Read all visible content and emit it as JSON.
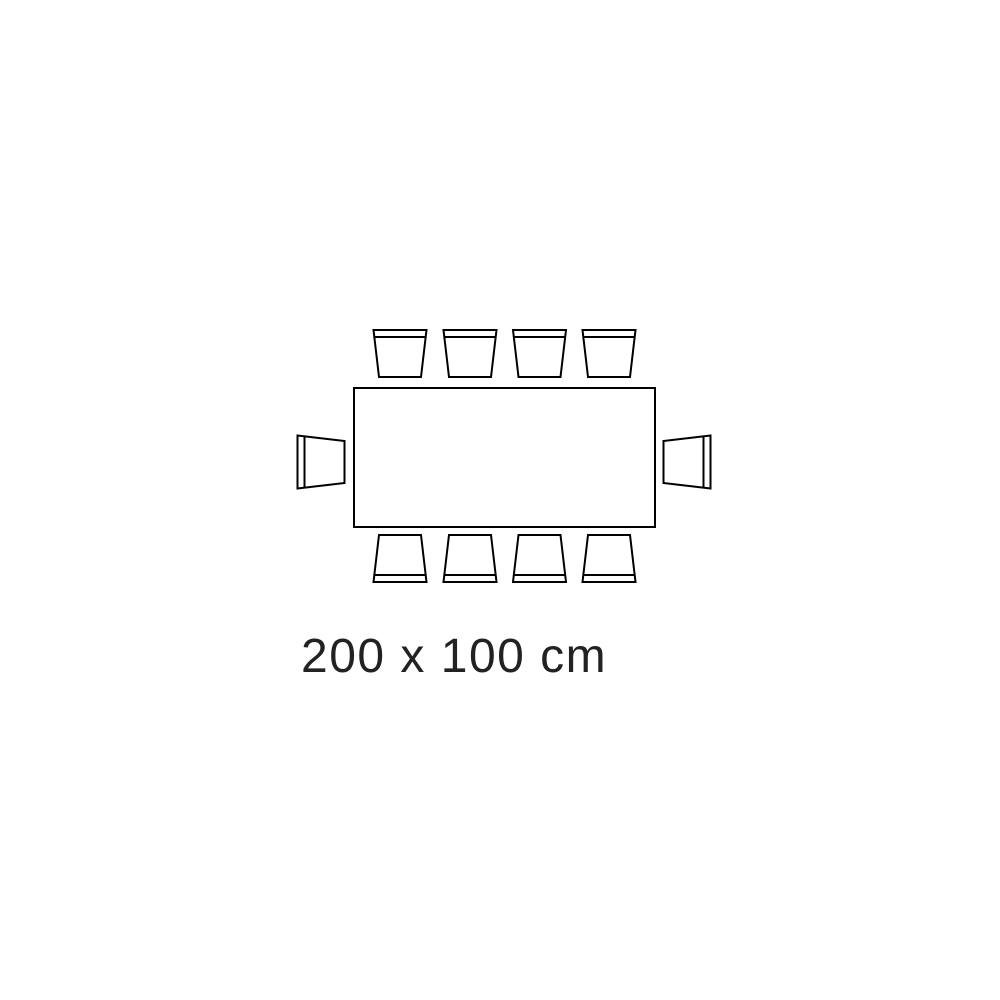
{
  "diagram": {
    "label": "200 x 100 cm",
    "table": {
      "shape": "rectangle",
      "width_cm": 200,
      "depth_cm": 100
    },
    "seats": {
      "total": 10,
      "top": 4,
      "bottom": 4,
      "left": 1,
      "right": 1
    },
    "colors": {
      "line": "#000000",
      "background": "#ffffff",
      "text": "#222222"
    }
  }
}
